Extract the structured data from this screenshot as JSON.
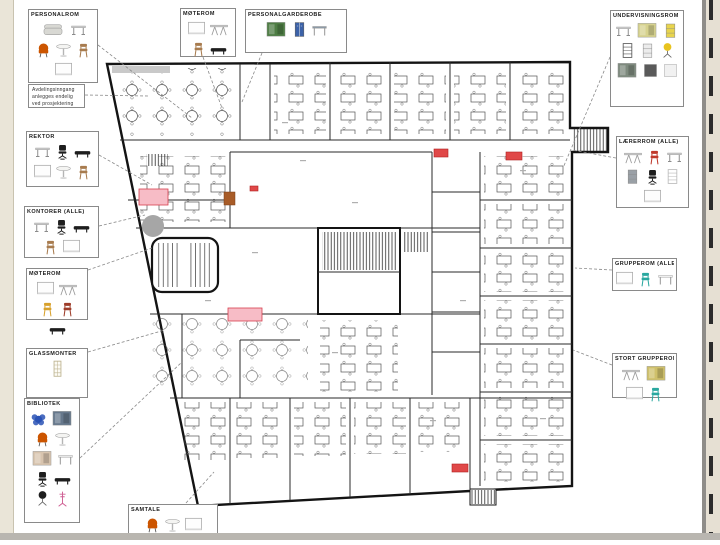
{
  "colors": {
    "margin_beige": "#eae5d8",
    "divider_gray": "#8f8d89",
    "bottom_bar": "#b9b6b0",
    "wall_black": "#141414",
    "highlight_pink": "#f7bcc6",
    "highlight_red": "#e04848",
    "circle_gray": "#a6a6a6",
    "accent_orange": "#a85c28"
  },
  "note": {
    "lines": [
      "Avdelingsinngang",
      "anlegges endelig",
      "ved prosjektering"
    ]
  },
  "callouts": [
    {
      "id": "personalrom",
      "title": "PERSONALROM",
      "items": [
        {
          "type": "sofa",
          "color": "#d8d8d3"
        },
        {
          "type": "desk",
          "color": "#d6d6d6"
        },
        {
          "type": "armchair",
          "color": "#cc5500"
        },
        {
          "type": "round-table",
          "color": "#f4f4f2"
        },
        {
          "type": "chair",
          "color": "#a87c4f"
        },
        {
          "type": "whiteboard",
          "color": "#f6f6f6"
        }
      ]
    },
    {
      "id": "moterom",
      "title": "MØTEROM",
      "items": [
        {
          "type": "whiteboard",
          "color": "#f6f6f6"
        },
        {
          "type": "trestle-table",
          "color": "#d0d0d0"
        },
        {
          "type": "chair",
          "color": "#a87c4f"
        },
        {
          "type": "bench",
          "color": "#1e1e1e"
        }
      ]
    },
    {
      "id": "personalgarderobe",
      "title": "PERSONALGARDEROBE",
      "items": [
        {
          "type": "photo",
          "color": "#4e7d44"
        },
        {
          "type": "locker",
          "color": "#3c62a8"
        },
        {
          "type": "table",
          "color": "#8d9aa6"
        }
      ]
    },
    {
      "id": "undervisningsrom",
      "title": "UNDERVISNINGSROM (ALLE)",
      "items": [
        {
          "type": "desk",
          "color": "#d8d8d8"
        },
        {
          "type": "photo",
          "color": "#d6d28e"
        },
        {
          "type": "cabinet",
          "color": "#e8d44d"
        },
        {
          "type": "shelf",
          "color": "#5a5a5a"
        },
        {
          "type": "cabinet",
          "color": "#ececec"
        },
        {
          "type": "stool",
          "color": "#e8c31e"
        },
        {
          "type": "photo",
          "color": "#7e8a7e"
        },
        {
          "type": "panel",
          "color": "#5a5a5a"
        },
        {
          "type": "panel",
          "color": "#f1f1f1"
        }
      ]
    },
    {
      "id": "rektor",
      "title": "REKTOR",
      "items": [
        {
          "type": "desk",
          "color": "#d4d4d4"
        },
        {
          "type": "office-chair",
          "color": "#1e1e1e"
        },
        {
          "type": "bench",
          "color": "#1e1e1e"
        },
        {
          "type": "whiteboard",
          "color": "#f6f6f6"
        },
        {
          "type": "round-table",
          "color": "#f4f4f2"
        },
        {
          "type": "chair",
          "color": "#a87c4f"
        }
      ]
    },
    {
      "id": "kontorer",
      "title": "KONTORER (ALLE)",
      "items": [
        {
          "type": "desk",
          "color": "#d4d4d4"
        },
        {
          "type": "office-chair",
          "color": "#1e1e1e"
        },
        {
          "type": "bench",
          "color": "#1e1e1e"
        },
        {
          "type": "chair",
          "color": "#a87c4f"
        },
        {
          "type": "whiteboard",
          "color": "#f6f6f6"
        }
      ]
    },
    {
      "id": "moterom-2",
      "title": "MØTEROM",
      "items": [
        {
          "type": "whiteboard",
          "color": "#f6f6f6"
        },
        {
          "type": "trestle-table",
          "color": "#d0d0d0"
        },
        {
          "type": "chair",
          "color": "#d8a12c"
        },
        {
          "type": "chair",
          "color": "#9e3d2a"
        },
        {
          "type": "bench",
          "color": "#1e1e1e"
        }
      ]
    },
    {
      "id": "glassmonter",
      "title": "GLASSMONTER",
      "items": [
        {
          "type": "display-cabinet",
          "color": "#bdb390"
        }
      ]
    },
    {
      "id": "bibliotek",
      "title": "BIBLIOTEK",
      "items": [
        {
          "type": "pouf",
          "color": "#2a52b5"
        },
        {
          "type": "photo",
          "color": "#66788c"
        },
        {
          "type": "armchair",
          "color": "#cc5500"
        },
        {
          "type": "round-table",
          "color": "#f4f4f2"
        },
        {
          "type": "photo",
          "color": "#d8c4ae"
        },
        {
          "type": "table",
          "color": "#e8e8e8"
        },
        {
          "type": "office-chair",
          "color": "#1e1e1e"
        },
        {
          "type": "bench",
          "color": "#1e1e1e"
        },
        {
          "type": "stool",
          "color": "#1e1e1e"
        },
        {
          "type": "coat-stand",
          "color": "#cf5f93"
        }
      ]
    },
    {
      "id": "samtale",
      "title": "SAMTALE",
      "items": [
        {
          "type": "armchair",
          "color": "#cc5500"
        },
        {
          "type": "round-table",
          "color": "#f4f4f2"
        },
        {
          "type": "whiteboard",
          "color": "#f6f6f6"
        }
      ]
    },
    {
      "id": "laererrom",
      "title": "LÆRERROM (ALLE)",
      "items": [
        {
          "type": "trestle-table",
          "color": "#d0d0d0"
        },
        {
          "type": "chair",
          "color": "#c0392b"
        },
        {
          "type": "desk",
          "color": "#d4d4d4"
        },
        {
          "type": "cabinet",
          "color": "#9aa0a6"
        },
        {
          "type": "office-chair",
          "color": "#1e1e1e"
        },
        {
          "type": "shelf",
          "color": "#bbbbbb"
        },
        {
          "type": "whiteboard",
          "color": "#f6f6f6"
        }
      ]
    },
    {
      "id": "grupperom",
      "title": "GRUPPEROM (ALLE)",
      "items": [
        {
          "type": "whiteboard",
          "color": "#f6f6f6"
        },
        {
          "type": "chair",
          "color": "#2aa8a0"
        },
        {
          "type": "table",
          "color": "#f0f0f0"
        }
      ]
    },
    {
      "id": "stort-grupperom",
      "title": "STORT GRUPPEROM",
      "items": [
        {
          "type": "trestle-table",
          "color": "#d0d0d0"
        },
        {
          "type": "photo",
          "color": "#cfc06a"
        },
        {
          "type": "whiteboard",
          "color": "#f6f6f6"
        },
        {
          "type": "chair",
          "color": "#2aa8a0"
        }
      ]
    }
  ]
}
